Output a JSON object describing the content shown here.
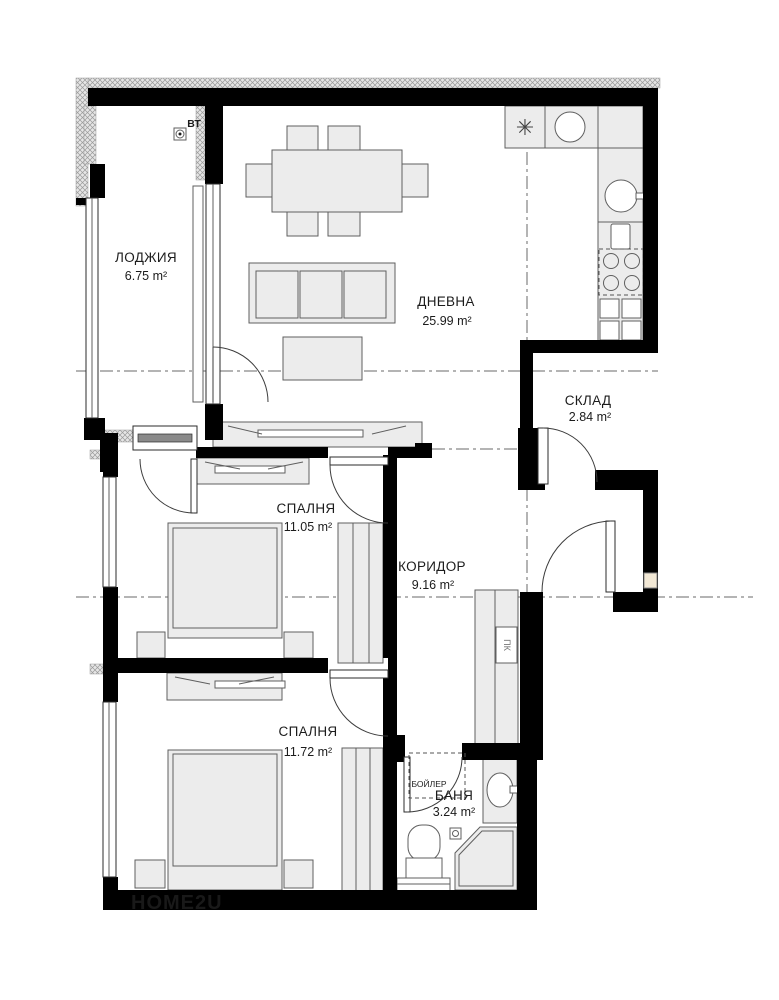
{
  "rooms": {
    "loggia": {
      "name": "ЛОДЖИЯ",
      "area": "6.75 m²"
    },
    "living": {
      "name": "ДНЕВНА",
      "area": "25.99 m²"
    },
    "storage": {
      "name": "СКЛАД",
      "area": "2.84 m²"
    },
    "bedroom1": {
      "name": "СПАЛНЯ",
      "area": "11.05 m²"
    },
    "corridor": {
      "name": "КОРИДОР",
      "area": "9.16 m²"
    },
    "bedroom2": {
      "name": "СПАЛНЯ",
      "area": "11.72 m²"
    },
    "bathroom": {
      "name": "БАНЯ",
      "area": "3.24 m²"
    }
  },
  "annotations": {
    "vent_shaft": "ВТ",
    "hall_cabinet": "ПК",
    "boiler": "БОЙЛЕР"
  },
  "icons": {
    "vent_fan": "✳"
  },
  "watermark": {
    "text": "HOME2U",
    "color": "#8a1a1a"
  },
  "colors": {
    "wall": "#000000",
    "furniture_fill": "#ececec",
    "outline": "#5f5f5f",
    "hatch": "#9a9a9a",
    "niche": "#f2e8d5"
  }
}
